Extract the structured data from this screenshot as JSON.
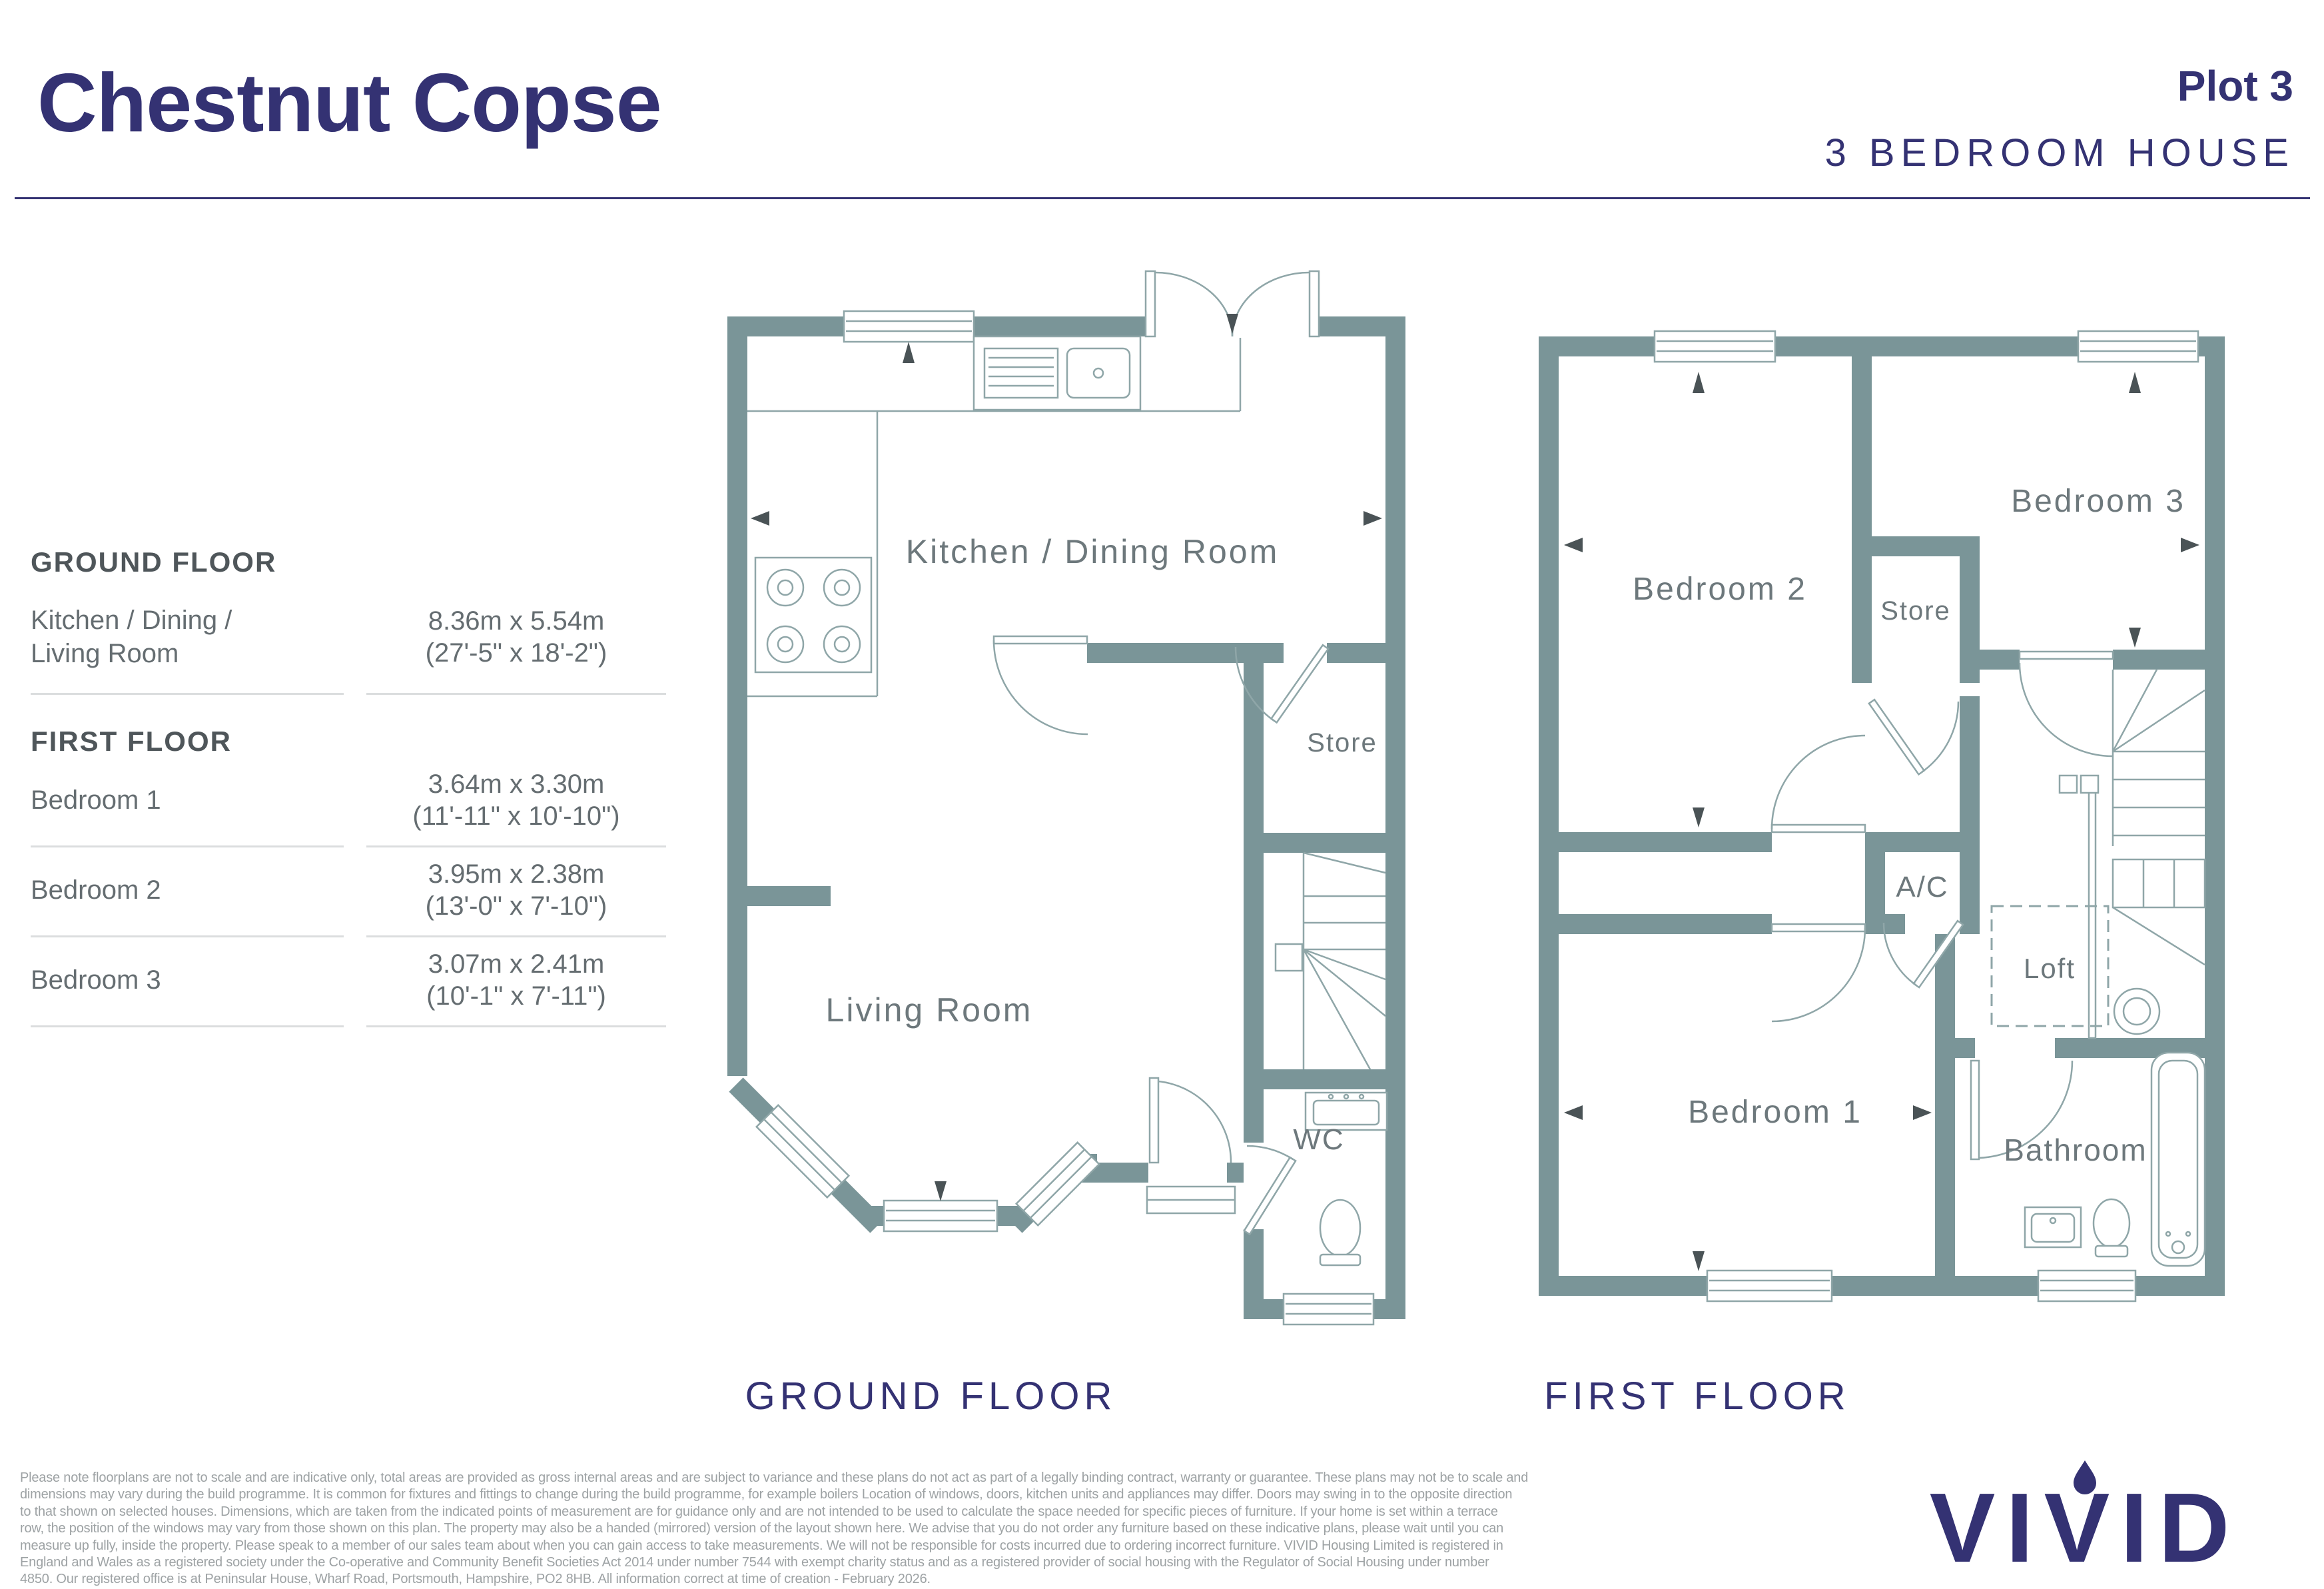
{
  "header": {
    "title": "Chestnut Copse",
    "plot": "Plot 3",
    "subtitle": "3 BEDROOM HOUSE"
  },
  "dimensions_table": {
    "sections": [
      {
        "heading": "GROUND FLOOR",
        "rows": [
          {
            "label_line1": "Kitchen / Dining /",
            "label_line2": "Living Room",
            "metric": "8.36m x 5.54m",
            "imperial": "(27'-5\" x 18'-2\")"
          }
        ]
      },
      {
        "heading": "FIRST FLOOR",
        "rows": [
          {
            "label": "Bedroom 1",
            "metric": "3.64m x 3.30m",
            "imperial": "(11'-11\" x 10'-10\")"
          },
          {
            "label": "Bedroom 2",
            "metric": "3.95m x 2.38m",
            "imperial": "(13'-0\" x 7'-10\")"
          },
          {
            "label": "Bedroom 3",
            "metric": "3.07m x 2.41m",
            "imperial": "(10'-1\" x 7'-11\")"
          }
        ]
      }
    ]
  },
  "ground_floor": {
    "caption": "GROUND FLOOR",
    "rooms": {
      "kitchen_dining": "Kitchen / Dining Room",
      "living": "Living Room",
      "store": "Store",
      "wc": "WC"
    }
  },
  "first_floor": {
    "caption": "FIRST FLOOR",
    "rooms": {
      "bedroom2": "Bedroom 2",
      "bedroom3": "Bedroom 3",
      "store": "Store",
      "ac": "A/C",
      "loft": "Loft",
      "bedroom1": "Bedroom 1",
      "bathroom": "Bathroom"
    }
  },
  "disclaimer": {
    "lines": [
      "Please note floorplans are not to scale and are indicative only, total areas are provided as gross internal areas and are subject to variance and these plans do not act as part of a legally binding contract, warranty or guarantee. These plans may not be to scale and",
      "dimensions may vary during the build programme. It is common for fixtures and fittings to change during the build programme, for example boilers Location of windows, doors, kitchen units and appliances may differ. Doors may swing in to the opposite direction",
      "to that shown on selected houses. Dimensions, which are taken from the indicated points of measurement are for guidance only and are not intended to be used to calculate the space needed for specific pieces of furniture. If your home is set within a terrace",
      "row, the position of the windows may vary from those shown on this plan. The property may also be a handed (mirrored) version of the layout shown here. We advise that you do not order any furniture based on these indicative plans, please wait until you can",
      "measure up fully, inside the property. Please speak to a member of our sales team about when you can gain access to take measurements. We will not be responsible for costs incurred due to ordering incorrect furniture. VIVID Housing Limited is registered in",
      "England and Wales as a registered society under the Co-operative and Community Benefit Societies Act 2014 under number 7544 with exempt charity status and as a registered provider of social housing with the Regulator of Social Housing under number",
      "4850. Our registered office is at Peninsular House, Wharf Road, Portsmouth, Hampshire, PO2 8HB. All information correct at time of creation - February 2026."
    ]
  },
  "logo": {
    "text": "VIVID"
  },
  "colors": {
    "navy": "#343273",
    "wall": "#7A9598",
    "line": "#8FA6A8",
    "roomlabel": "#6D787C",
    "arrow": "#4A5356"
  }
}
